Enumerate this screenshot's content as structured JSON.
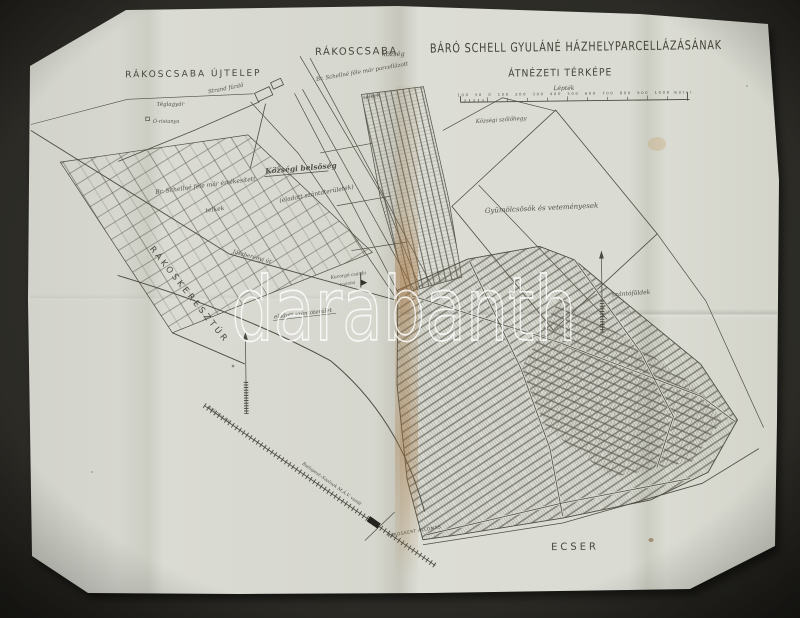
{
  "photo": {
    "background_color": "#2b2a25",
    "paper_color": "#d8d9d1",
    "ink_color": "#4a4940",
    "stain_color": "#b07c42"
  },
  "watermark": "darabanth",
  "map": {
    "title_line1": "BÁRÓ SCHELL GYULÁNÉ HÁZHELYPARCELLÁZÁSÁNAK",
    "title_line2": "ÁTNÉZETI TÉRKÉPE",
    "scale": {
      "label": "Lépték",
      "ticks": [
        "100",
        "50",
        "0",
        "100",
        "200",
        "300",
        "400",
        "500",
        "600",
        "700",
        "800",
        "900",
        "1000 méter"
      ]
    },
    "places": {
      "rakoscsaba_ujtelep": "RÁKOSCSABA ÚJTELEP",
      "rakoscsaba": "RÁKOSCSABA",
      "kozseg": "község",
      "strand_furdo": "Strand fürdő",
      "teglagyar": "Téglagyár",
      "o_tanya": "Ó-ristanya",
      "schellne_parc_1": "Br. Schellné féle már parcellázott",
      "schellne_parc_2": "telkek",
      "kozsegi_belsoseg": "Községi belsőség",
      "schellne_ert_1": "Br. Schellné féle már értékesített",
      "schellne_ert_2": "telkek",
      "eladott_szantoteruletek": "(eladott szántóterületek)",
      "kozsegi_szolohegy": "Községi szőlőhegy",
      "gyumolcsosok": "Gyümölcsösök és veteményesek",
      "jaszberenyi_ut": "Jászberényi út",
      "rakoskeresztur": "RÁKOSKERESZTÚR",
      "kucorgo_csarda": "Kucorgó csárda",
      "kucorgo_csarda_2": "(csárda)",
      "eladott_szantoterulet": "eladott szántóterület",
      "szantofoldek": "szántóföldek",
      "ecser": "ECSER",
      "allomas": "RÁKOSKERT ÁLLOMÁS",
      "vasut": "Budapest–Szolnok M.Á.V. vasút",
      "vasut_irany": "Budapest felé"
    }
  }
}
